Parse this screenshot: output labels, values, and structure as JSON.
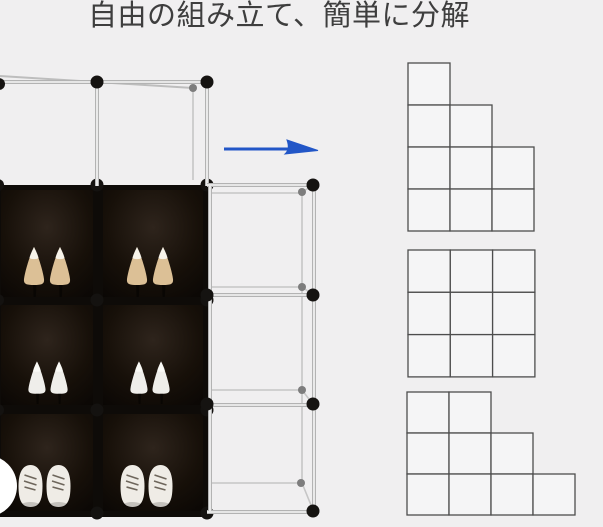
{
  "title": {
    "text": "自由の組み立て、簡単に分解"
  },
  "colors": {
    "background": "#f0eff0",
    "arrow_blue": "#2256c7",
    "diagram_stroke": "#4d4d4d",
    "diagram_fill": "#f5f5f6",
    "rack_black": "#0e0b08",
    "frame_tube_edge": "#b3b3b3",
    "frame_tube_core": "#f7f7f7",
    "connector_black": "#151311",
    "connector_gray": "#8a8a8a",
    "shoe_beige": "#dcc096",
    "shoe_white": "#efeeea",
    "sneaker_white": "#efece6"
  },
  "photo": {
    "description": "cube-shoe-rack-photo",
    "empty_top_row_cells": 2,
    "shelves": [
      {
        "label": "top-shelf",
        "cells": [
          "beige-high-heels",
          "beige-high-heels"
        ]
      },
      {
        "label": "middle-shelf",
        "cells": [
          "white-high-heels",
          "white-high-heels"
        ]
      },
      {
        "label": "bottom-shelf",
        "cells": [
          "white-sneakers",
          "white-sneakers"
        ]
      }
    ],
    "attach_column_cells": 3
  },
  "arrow": {
    "direction": "right"
  },
  "diagrams": {
    "configurations": [
      {
        "name": "staircase-tall-left",
        "rows_cells": [
          1,
          2,
          3,
          3
        ]
      },
      {
        "name": "grid-3x3",
        "rows_cells": [
          3,
          3,
          3
        ]
      },
      {
        "name": "staircase-wide",
        "rows_cells": [
          2,
          3,
          4
        ]
      }
    ]
  }
}
